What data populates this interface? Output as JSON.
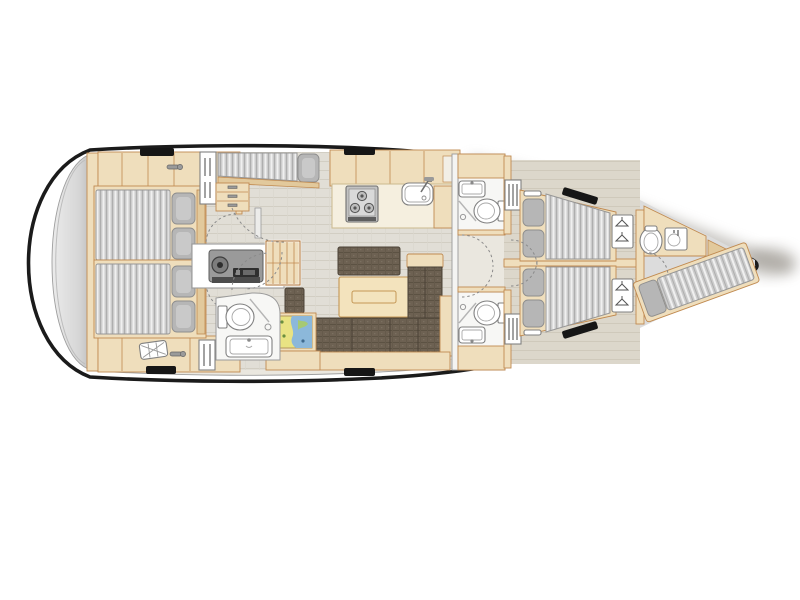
{
  "meta": {
    "title": "Sailing yacht interior layout plan, top view, bow pointing right",
    "diagram_type": "boat-floorplan"
  },
  "palette": {
    "hull_line": "#1b1b1b",
    "deck_white": "#ffffff",
    "interior_base": "#eae7df",
    "wood": "#efdebc",
    "wood_dark": "#e2c99c",
    "wood_border": "#c08a50",
    "salon_floor": "#e1ded6",
    "cabin_floor": "#dcd7cb",
    "bow_floor": "#dcdcdc",
    "mattress_gray": "#cccccc",
    "pillow_gray": "#b6b6b6",
    "sofa_brown": "#6d6152",
    "table_wood": "#f3e3bd",
    "counter": "#f5efdf",
    "swim_platform": "#d9d9d9",
    "chart_yellow": "#e9e383",
    "chart_blue": "#8cb8da",
    "chart_green": "#a6c973",
    "engine_gray": "#9a9a9a",
    "hatch_black": "#161616",
    "shadow": "#8f8a82"
  },
  "rooms": [
    {
      "id": "swim-platform",
      "name": "Stern swim platform"
    },
    {
      "id": "aft-cabin-port",
      "name": "Aft double cabin (port)"
    },
    {
      "id": "aft-cabin-starboard",
      "name": "Aft double cabin (starboard)"
    },
    {
      "id": "engine-room",
      "name": "Engine compartment"
    },
    {
      "id": "companionway",
      "name": "Companionway stairs"
    },
    {
      "id": "utility-berth",
      "name": "Utility / skipper berth (port)"
    },
    {
      "id": "galley",
      "name": "Galley with stove and sink"
    },
    {
      "id": "salon",
      "name": "Salon with table, bench and L-sofa"
    },
    {
      "id": "nav-station",
      "name": "Navigation chart table"
    },
    {
      "id": "aft-head",
      "name": "Aft bathroom (toilet, shower, sink)"
    },
    {
      "id": "fwd-head-port",
      "name": "Forward bathroom (port)"
    },
    {
      "id": "fwd-head-starboard",
      "name": "Forward bathroom (starboard)"
    },
    {
      "id": "fwd-cabin-port",
      "name": "Forward double cabin (port)"
    },
    {
      "id": "fwd-cabin-starboard",
      "name": "Forward double cabin (starboard)"
    },
    {
      "id": "bow-cabin",
      "name": "Bow crew cabin with berth, toilet and sink"
    }
  ],
  "fixtures": {
    "stove_burners": 3,
    "toilets": 4,
    "sinks": 5,
    "showers": 3,
    "double_beds": 4,
    "single_berths": 2,
    "deck_hatches": 6,
    "hanging_lockers": 4
  }
}
